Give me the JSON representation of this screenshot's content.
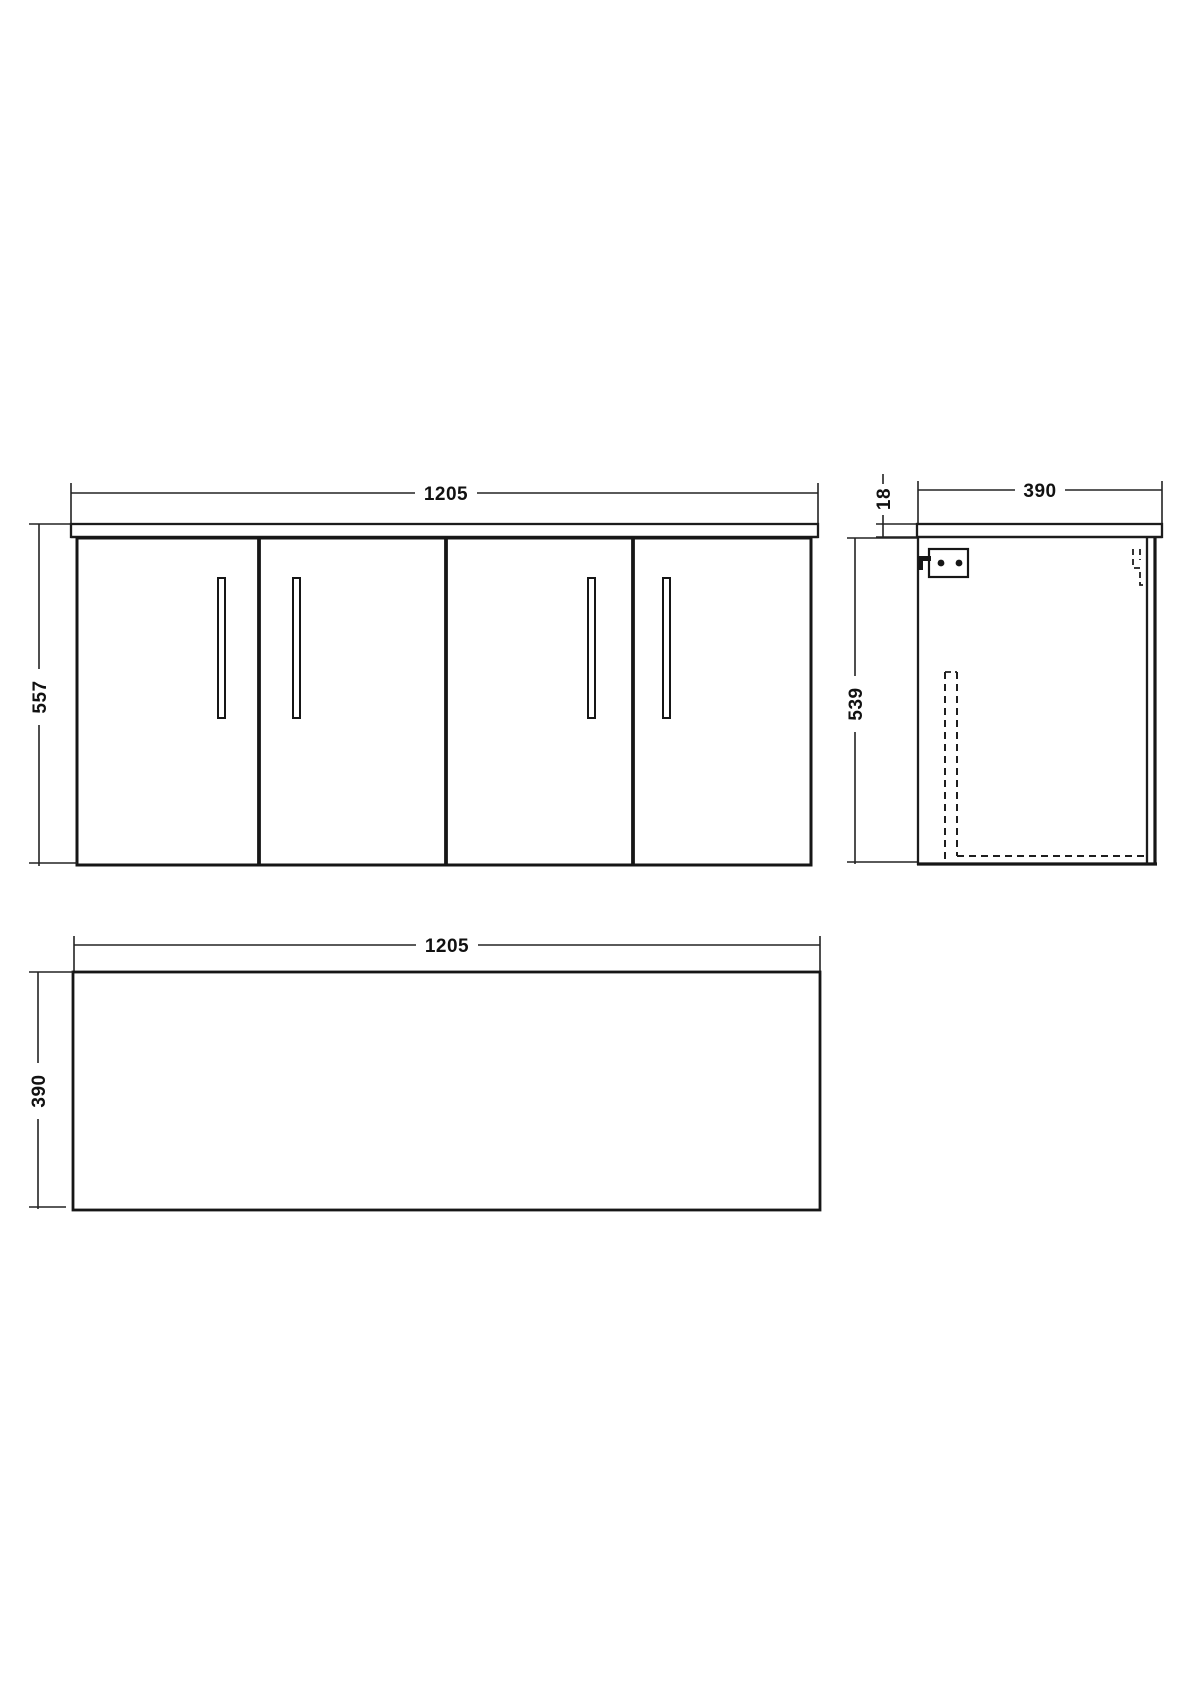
{
  "colors": {
    "line": "#1c1c1c",
    "background": "#ffffff",
    "text": "#111111"
  },
  "views": {
    "front": {
      "width_label": "1205",
      "height_label": "557"
    },
    "side": {
      "depth_label": "390",
      "worktop_thickness_label": "18",
      "height_label": "539"
    },
    "plan": {
      "width_label": "1205",
      "depth_label": "390"
    }
  }
}
